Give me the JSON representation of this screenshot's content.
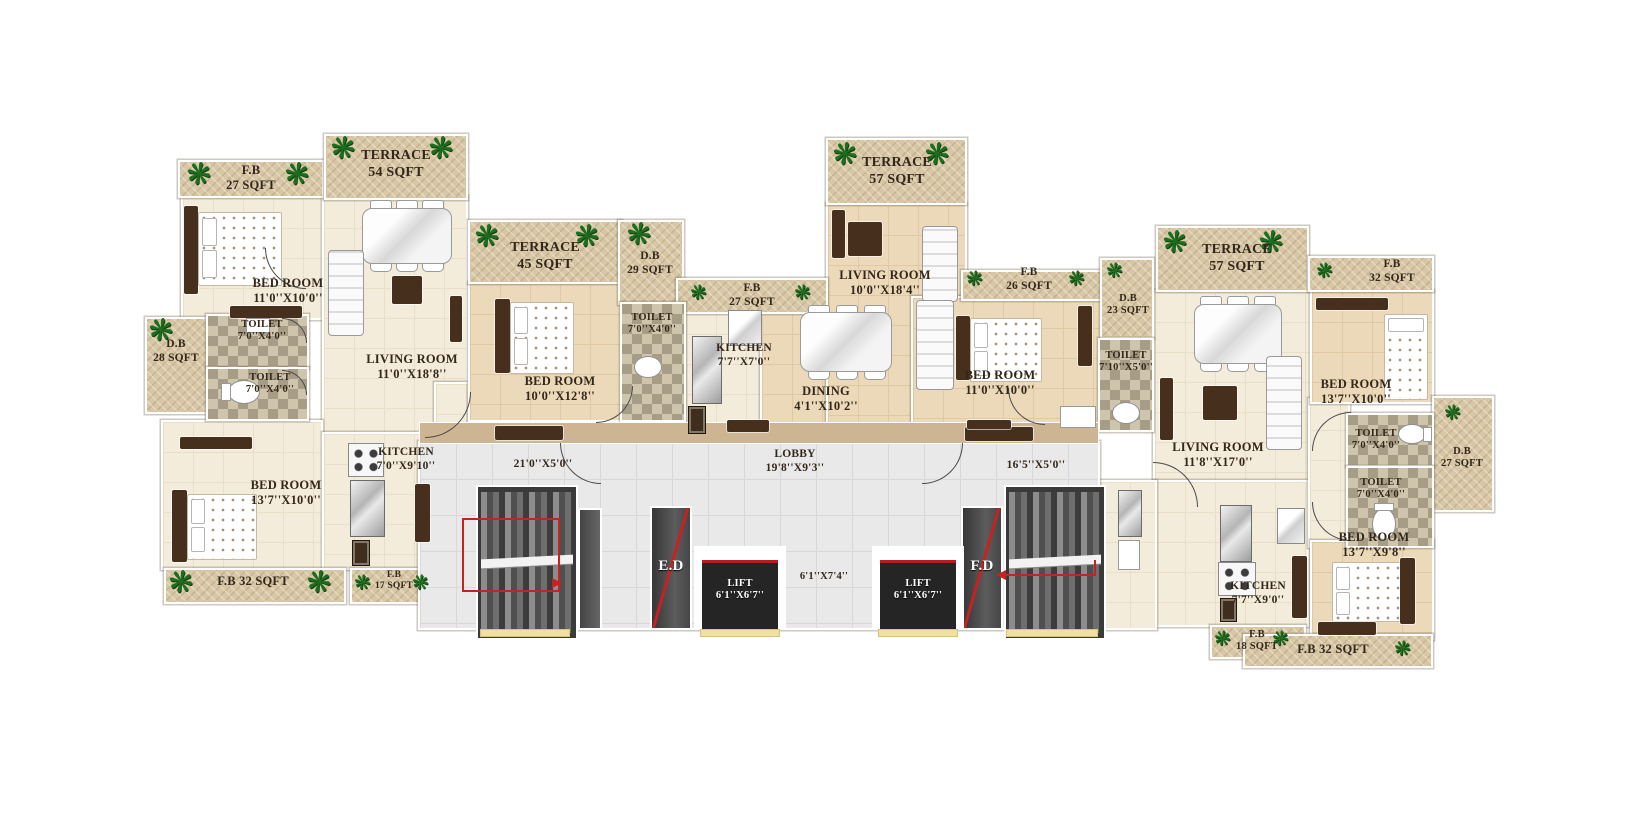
{
  "icons": {
    "plant": "❋"
  },
  "colors": {
    "floor_cream": "#f4ecdb",
    "floor_tan": "#ecd9ba",
    "terrace_pattern": "#d8c7a5",
    "toilet_checker": "#bdb298",
    "lobby_gray": "#e9e9e9",
    "wood_dark": "#46301d",
    "lift_dark": "#252525",
    "accent_red": "#c62222",
    "plant_green": "#1d6e1f"
  },
  "rooms": {
    "fb_a_top": {
      "label": "F.B",
      "size": "27 SQFT"
    },
    "terrace_a": {
      "label": "TERRACE",
      "size": "54 SQFT"
    },
    "bed_a1": {
      "label": "BED ROOM",
      "size": "11'0''X10'0''"
    },
    "living_a": {
      "label": "LIVING ROOM",
      "size": "11'0''X18'8''"
    },
    "toilet_a1": {
      "label": "TOILET",
      "size": "7'0''X4'0''"
    },
    "toilet_a2": {
      "label": "TOILET",
      "size": "7'0''X4'0''"
    },
    "db_a": {
      "label": "D.B",
      "size": "28 SQFT"
    },
    "bed_a2": {
      "label": "BED ROOM",
      "size": "13'7''X10'0''"
    },
    "kitchen_a": {
      "label": "KITCHEN",
      "size": "7'0''X9'10''"
    },
    "fb_a_bot1": {
      "label": "F.B 32 SQFT"
    },
    "fb_a_bot2": {
      "label": "F.B",
      "size": "17 SQFT"
    },
    "terrace_b": {
      "label": "TERRACE",
      "size": "45 SQFT"
    },
    "bed_b": {
      "label": "BED ROOM",
      "size": "10'0''X12'8''"
    },
    "db_b": {
      "label": "D.B",
      "size": "29 SQFT"
    },
    "toilet_b": {
      "label": "TOILET",
      "size": "7'0''X4'0''"
    },
    "fb_b": {
      "label": "F.B",
      "size": "27 SQFT"
    },
    "kitchen_b": {
      "label": "KITCHEN",
      "size": "7'7''X7'0''"
    },
    "dining_c": {
      "label": "DINING",
      "size": "4'1''X10'2''"
    },
    "terrace_c": {
      "label": "TERRACE",
      "size": "57 SQFT"
    },
    "living_c": {
      "label": "LIVING ROOM",
      "size": "10'0''X18'4''"
    },
    "fb_c": {
      "label": "F.B",
      "size": "26 SQFT"
    },
    "bed_c": {
      "label": "BED ROOM",
      "size": "11'0''X10'0''"
    },
    "db_c": {
      "label": "D.B",
      "size": "23 SQFT"
    },
    "toilet_c": {
      "label": "TOILET",
      "size": "7'10''X5'0''"
    },
    "terrace_d": {
      "label": "TERRACE",
      "size": "57 SQFT"
    },
    "fb_d_top": {
      "label": "F.B",
      "size": "32 SQFT"
    },
    "living_d": {
      "label": "LIVING ROOM",
      "size": "11'8''X17'0''"
    },
    "bed_d1": {
      "label": "BED ROOM",
      "size": "13'7''X10'0''"
    },
    "toilet_d1": {
      "label": "TOILET",
      "size": "7'0''X4'0''"
    },
    "toilet_d2": {
      "label": "TOILET",
      "size": "7'0''X4'0''"
    },
    "db_d": {
      "label": "D.B",
      "size": "27 SQFT"
    },
    "bed_d2": {
      "label": "BED ROOM",
      "size": "13'7''X9'8''"
    },
    "kitchen_d": {
      "label": "KITCHEN",
      "size": "7'7''X9'0''"
    },
    "fb_d_mid": {
      "label": "F.B",
      "size": "18 SQFT"
    },
    "fb_d_bottom": {
      "label": "F.B 32 SQFT"
    }
  },
  "common": {
    "corridor_left": "21'0''X5'0''",
    "lobby_label": "LOBBY",
    "lobby_size": "19'8''X9'3''",
    "corridor_right": "16'5''X5'0''",
    "ed": "E.D",
    "fd": "F.D",
    "lift": "LIFT",
    "lift_size": "6'1''X6'7''",
    "lift_lobby_size": "6'1''X7'4''"
  }
}
